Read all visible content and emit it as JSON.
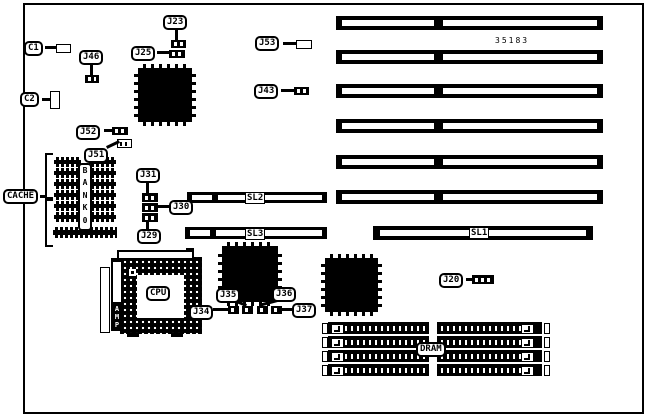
{
  "diagram": {
    "type": "motherboard-connector-location-diagram",
    "board_number": "35183",
    "colors": {
      "line": "#000000",
      "background": "#ffffff"
    },
    "labels": {
      "c1": "C1",
      "c2": "C2",
      "j20": "J20",
      "j23": "J23",
      "j25": "J25",
      "j29": "J29",
      "j30": "J30",
      "j31": "J31",
      "j34": "J34",
      "j35": "J35",
      "j36": "J36",
      "j37": "J37",
      "j43": "J43",
      "j46": "J46",
      "j51": "J51",
      "j52": "J52",
      "j53": "J53",
      "cache": "CACHE",
      "cpu": "CPU",
      "dram": "DRAM",
      "sl1": "SL1",
      "sl2": "SL2",
      "sl3": "SL3",
      "bank": "BANK0",
      "amp": "AMP"
    },
    "components": {
      "isa_slot_count": 6,
      "vl_slots": [
        "SL1",
        "SL2",
        "SL3"
      ],
      "simm_socket_count": 4,
      "cache_chip_rows": 6,
      "cache_chip_columns": 2
    }
  }
}
